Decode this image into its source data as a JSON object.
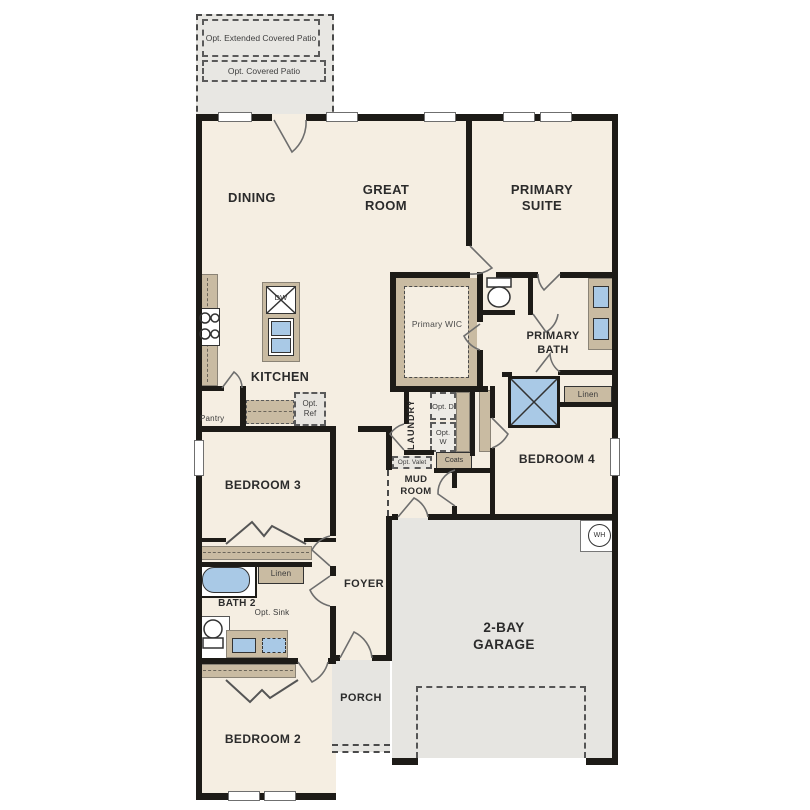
{
  "plan_title": "single-story floor plan",
  "colors": {
    "floor": "#f5eee2",
    "wall": "#1d1b17",
    "cabinet_tan": "#c9bba2",
    "fixture_blue": "#a9c9e6",
    "concrete_gray": "#e6e5e1"
  },
  "patio": {
    "extended_label": "Opt. Extended Covered Patio",
    "covered_label": "Opt. Covered Patio"
  },
  "rooms": {
    "dining": "DINING",
    "great_room": "GREAT ROOM",
    "primary_suite": "PRIMARY SUITE",
    "kitchen": "KITCHEN",
    "primary_wic": "Primary WIC",
    "primary_bath": "PRIMARY BATH",
    "laundry": "LAUNDRY",
    "mud_room": "MUD ROOM",
    "bedroom4": "BEDROOM 4",
    "bedroom3": "BEDROOM 3",
    "bath2": "BATH 2",
    "foyer": "FOYER",
    "porch": "PORCH",
    "bedroom2": "BEDROOM 2",
    "garage": "2-BAY GARAGE"
  },
  "features": {
    "pantry": "Pantry",
    "opt_ref": "Opt. Ref",
    "dishwasher": "DW",
    "opt_dryer": "Opt. D",
    "opt_washer": "Opt. W",
    "opt_valet": "Opt. Valet",
    "coats": "Coats",
    "linen_primary": "Linen",
    "linen_bath2": "Linen",
    "opt_sink": "Opt. Sink",
    "water_heater": "WH"
  }
}
